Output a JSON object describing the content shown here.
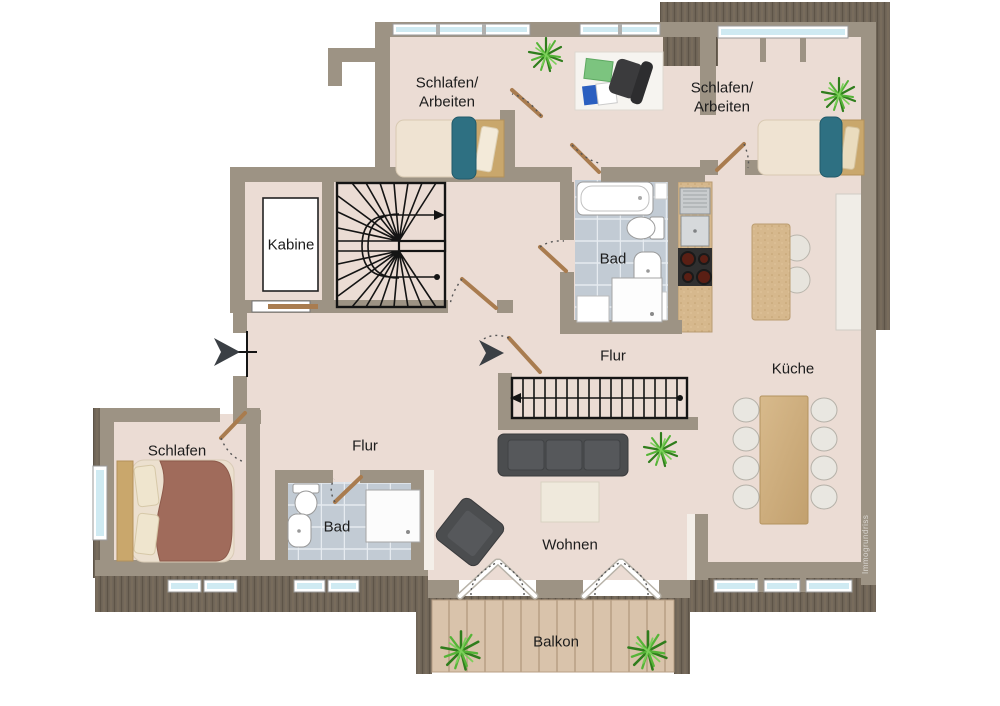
{
  "watermark": "Immogrundriss",
  "rooms": {
    "bedroom_top_left": {
      "label": "Schlafen/\nArbeiten"
    },
    "bedroom_top_right": {
      "label": "Schlafen/\nArbeiten"
    },
    "kabine": {
      "label": "Kabine"
    },
    "bad_top": {
      "label": "Bad"
    },
    "flur_top": {
      "label": "Flur"
    },
    "kueche": {
      "label": "Küche"
    },
    "schlafen": {
      "label": "Schlafen"
    },
    "flur_bottom": {
      "label": "Flur"
    },
    "bad_bottom": {
      "label": "Bad"
    },
    "wohnen": {
      "label": "Wohnen"
    },
    "balkon": {
      "label": "Balkon"
    }
  },
  "palette": {
    "wall": "#9d9384",
    "floor": "#ebdcd4",
    "bath_tile": "#c2cbd4",
    "roof_dark": "#6f6457",
    "deck_wood": "#d9c3ab",
    "counter_wood": "#d6b88d",
    "window_glass": "#cfeaf2",
    "door_wood": "#a97c4f",
    "sofa_gray": "#4b4d4f",
    "bed_teal": "#2e7082",
    "blanket_brown": "#a06b5b",
    "plant_green": "#4da32f"
  }
}
